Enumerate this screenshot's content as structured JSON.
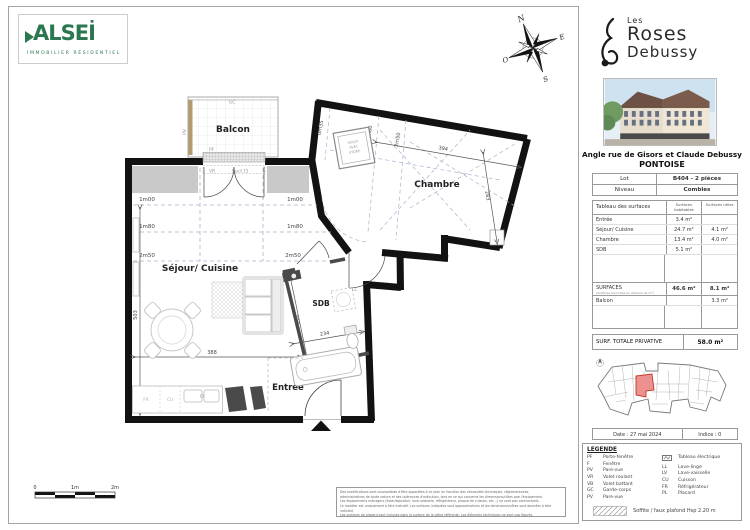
{
  "branding": {
    "alsei": "ALSEİ",
    "alsei_sub": "IMMOBILIER RÉSIDENTIEL"
  },
  "project": {
    "les": "Les",
    "name1": "Roses",
    "name2": "Debussy"
  },
  "address": {
    "line1": "Angle rue de Gisors et Claude Debussy",
    "line2": "PONTOISE"
  },
  "lot": {
    "label": "Lot",
    "value": "B404 - 2 pièces",
    "level_label": "Niveau",
    "level_value": "Combles"
  },
  "surfaces": {
    "title": "Tableau des surfaces",
    "col_hab": "Surfaces habitables",
    "col_ut": "Surfaces utiles",
    "rows": [
      {
        "name": "Entrée",
        "hab": "3.4  m²",
        "ut": ""
      },
      {
        "name": "Séjour/ Cuisine",
        "hab": "24.7  m²",
        "ut": "4.1   m²"
      },
      {
        "name": "Chambre",
        "hab": "13.4  m²",
        "ut": "4.0  m²"
      },
      {
        "name": "SDB",
        "hab": "5.1  m²",
        "ut": ""
      }
    ],
    "total_label": "SURFACES",
    "total_note": "(Surfaces arrondies au dixième de m²)",
    "total_hab": "46.6 m²",
    "total_ut": "8.1 m²",
    "balcon_label": "Balcon",
    "balcon_value": "3.3  m²",
    "privative_label": "SURF. TOTALE PRIVATIVE",
    "privative_value": "58.0 m²"
  },
  "meta": {
    "date": "Date : 27 mai 2024",
    "indice": "Indice : 0"
  },
  "legend": {
    "title": "LEGENDE",
    "left": [
      {
        "a": "PF",
        "l": "Porte-fenêtre"
      },
      {
        "a": "F",
        "l": "Fenêtre"
      },
      {
        "a": "PV",
        "l": "Pare-vue"
      },
      {
        "a": "VR",
        "l": "Volet roulant"
      },
      {
        "a": "VB",
        "l": "Volet battant"
      },
      {
        "a": "GC",
        "l": "Garde-corps"
      },
      {
        "a": "PV",
        "l": "Pare-vue"
      }
    ],
    "right": [
      {
        "a": "",
        "l": "Tableau électrique"
      },
      {
        "a": "LL",
        "l": "Lave-linge"
      },
      {
        "a": "LV",
        "l": "Lave-vaisselle"
      },
      {
        "a": "CU",
        "l": "Cuisson"
      },
      {
        "a": "FR",
        "l": "Réfrigérateur"
      },
      {
        "a": "PL",
        "l": "Placard"
      }
    ],
    "soffite": "Soffite / faux plafond Hsp 2.20 m"
  },
  "plan": {
    "rooms": {
      "balcon": "Balcon",
      "chambre": "Chambre",
      "sejour": "Séjour/ Cuisine",
      "sdb": "SDB",
      "entree": "Entrée"
    },
    "heights": {
      "h035": "0m35",
      "h100": "1m00",
      "h180": "1m80",
      "h250": "2m50"
    },
    "dims": {
      "d394": "394",
      "d283": "283",
      "d503": "503",
      "d388": "388",
      "d227": "227",
      "d234": "234"
    },
    "tags": {
      "gc": "GC",
      "pv": "PV",
      "pf": "PF",
      "vr": "VR",
      "seuil": "Seuil 15",
      "ll": "LL",
      "cu": "CU",
      "fr": "FR"
    },
    "velux": [
      "VELUX",
      "AVEC",
      "STORE"
    ],
    "compass": {
      "n": "N",
      "e": "E",
      "s": "S",
      "o": "O"
    },
    "scale": {
      "s0": "0",
      "s1": "1m",
      "s2": "2m"
    }
  },
  "disclaimer": [
    "Des modifications sont susceptibles d'être apportées à ce plan en fonction des nécessités techniques, réglementaires,",
    "administratives de toute nature et des tolérances d'exécution, tant en ce qui concerne les dimensions/côtes que l'équipement.",
    "Les équipements ménagers (évier/égouttoir, lave-vaisselle, réfrigérateur, plaque de cuisson, etc...) ne sont pas contractuels.",
    "Le mobilier est uniquement à titre indicatif. Les surfaces indiquées sont approximatives et les dimensions/côtes sont données à titre indicatif.",
    "Les surfaces de placard sont incluses dans la surface de la pièce référente. Les éléments techniques ne sont pas figurés."
  ]
}
